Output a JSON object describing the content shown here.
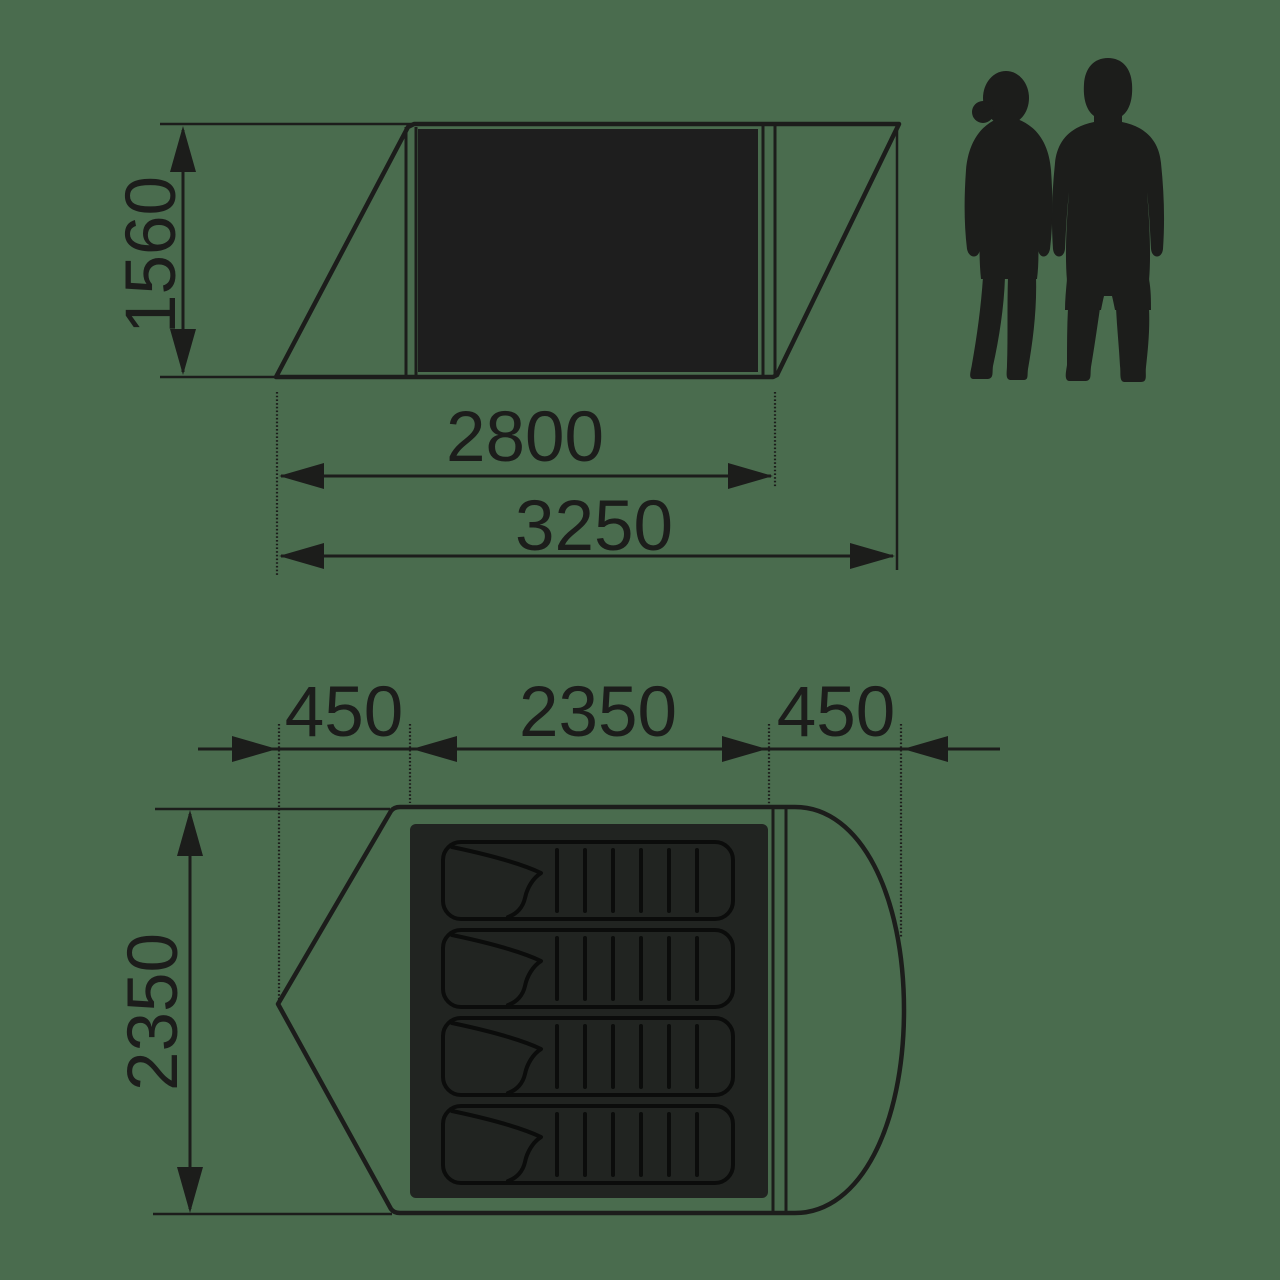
{
  "diagram": {
    "subject": "tent-dimension-drawing",
    "colors": {
      "background": "#4a6c4e",
      "ink": "#1c1d1b",
      "inner_panel": "#1e1e1e",
      "floor": "#212421",
      "pad_outline": "#0b0c0b"
    },
    "side_view": {
      "height_label": "1560",
      "inner_width_label": "2800",
      "total_width_label": "3250"
    },
    "top_view": {
      "left_porch_label": "450",
      "inner_length_label": "2350",
      "right_porch_label": "450",
      "width_label": "2350",
      "sleeping_pad_count": 4
    },
    "figures": {
      "left": "woman-silhouette",
      "right": "man-silhouette"
    }
  }
}
